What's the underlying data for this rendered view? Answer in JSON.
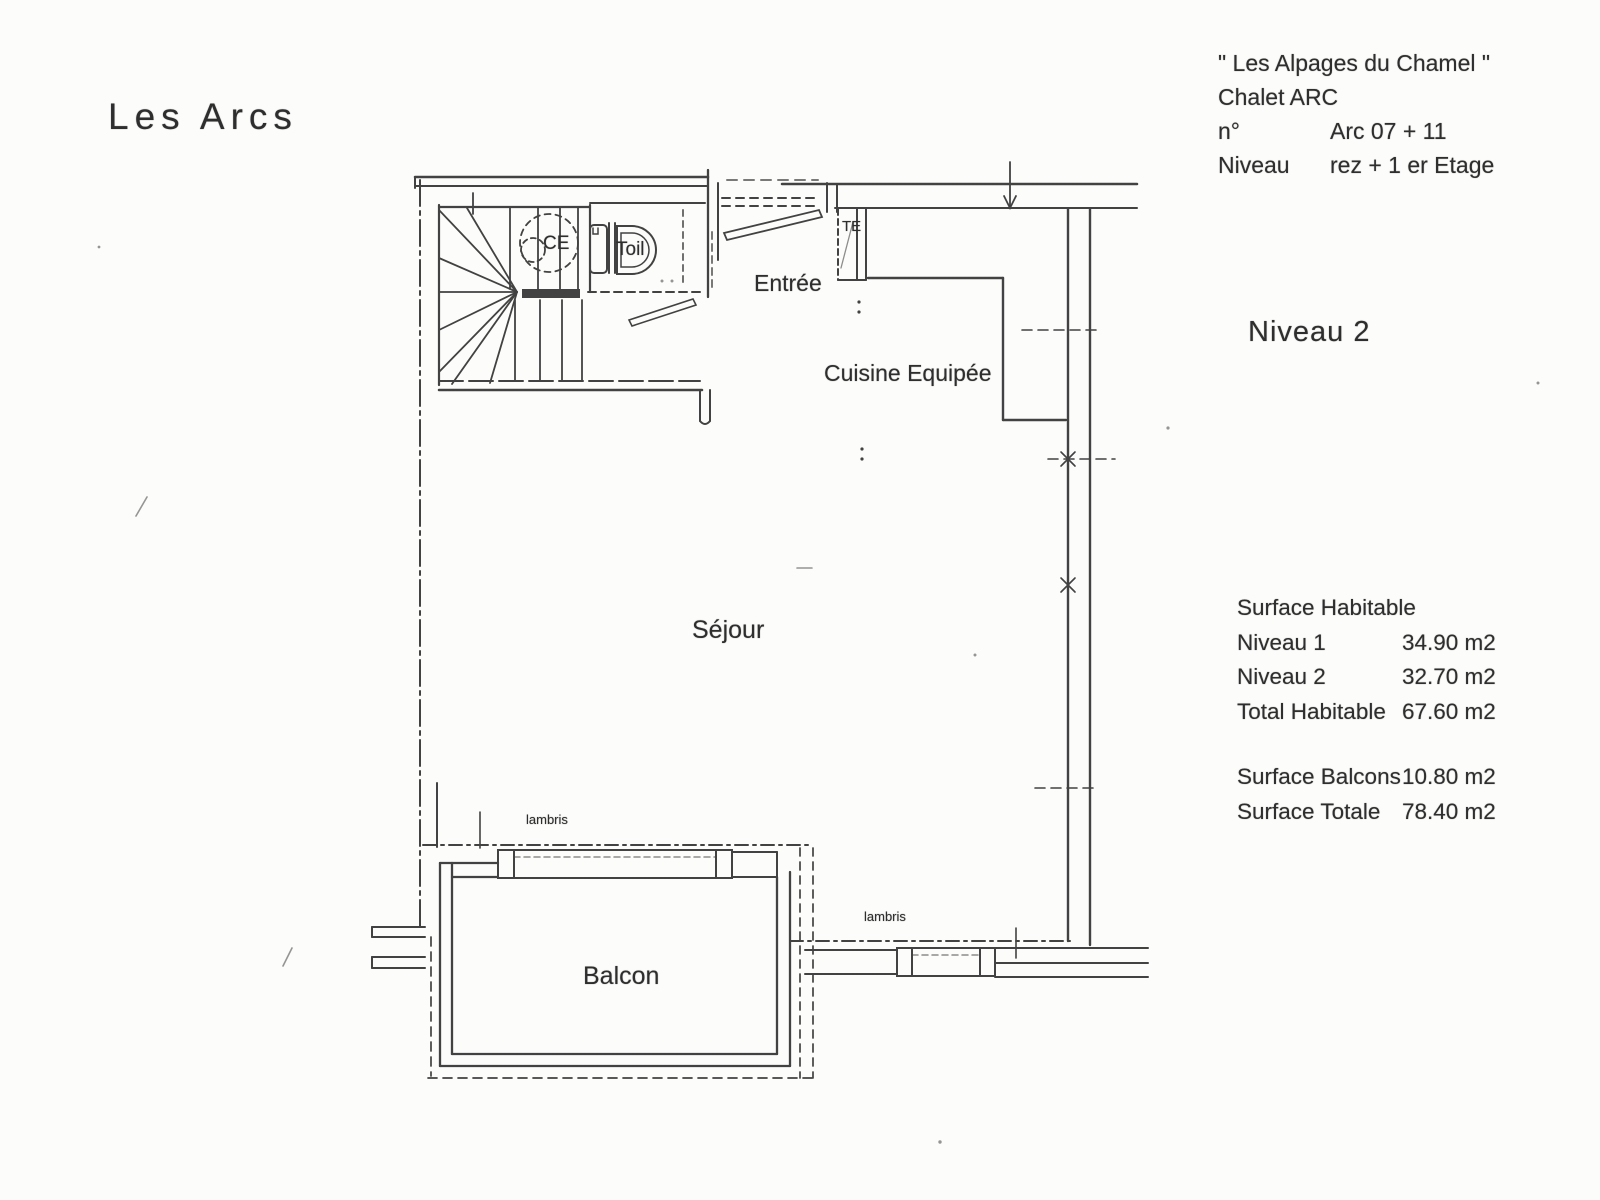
{
  "page_title": "Les Arcs",
  "header": {
    "project_name": "\" Les Alpages du Chamel \"",
    "chalet_name": "Chalet ARC",
    "unit_label": "n°",
    "unit_value": "Arc 07 + 11",
    "level_label": "Niveau",
    "level_value": "rez + 1 er Etage"
  },
  "level_title": "Niveau 2",
  "surface_table": {
    "title": "Surface Habitable",
    "rows": [
      {
        "label": "Niveau 1",
        "value": "34.90 m2"
      },
      {
        "label": "Niveau 2",
        "value": "32.70 m2"
      },
      {
        "label": "Total Habitable",
        "value": "67.60 m2"
      }
    ],
    "rows2": [
      {
        "label": "Surface Balcons",
        "value": "10.80 m2"
      },
      {
        "label": "Surface Totale",
        "value": "78.40 m2"
      }
    ]
  },
  "rooms": {
    "entree": "Entrée",
    "cuisine": "Cuisine Equipée",
    "sejour": "Séjour",
    "balcon": "Balcon",
    "lambris_left": "lambris",
    "lambris_right": "lambris",
    "water_heater": "CE",
    "toilet": "Toil",
    "electrical_panel": "TE"
  },
  "ink_color": "#2e2e2e"
}
